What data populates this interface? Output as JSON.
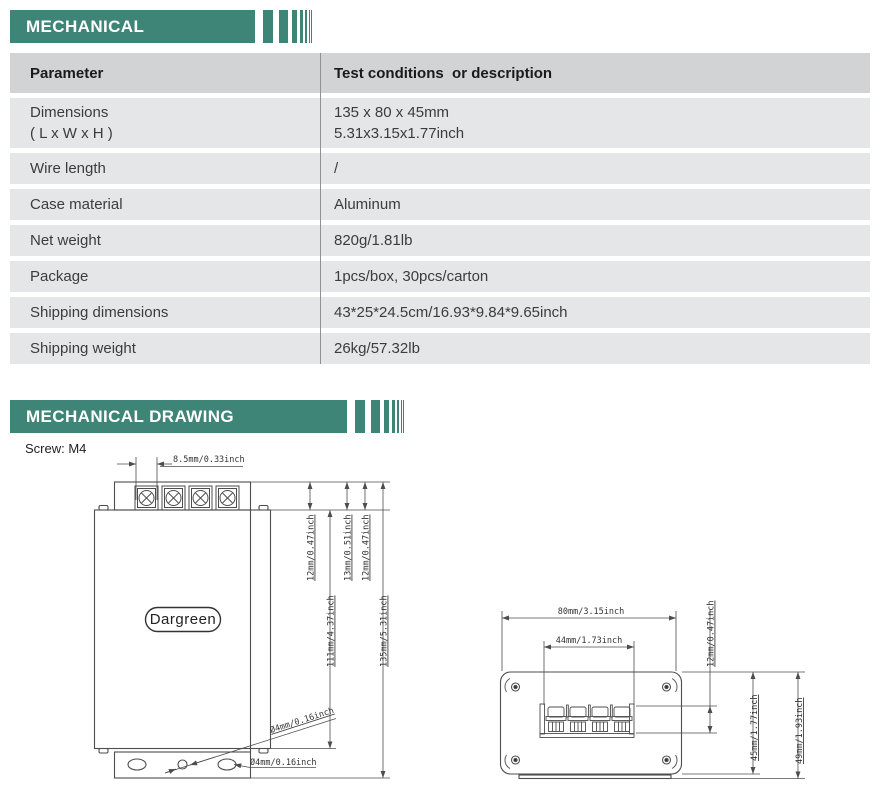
{
  "theme": {
    "accent_teal": "#3e8577",
    "table_header_bg": "#d1d3d4",
    "table_row_bg": "#e5e6e7"
  },
  "section_mechanical": {
    "title": "MECHANICAL"
  },
  "section_drawing": {
    "title": "MECHANICAL DRAWING",
    "screw_note": "Screw:  M4"
  },
  "table": {
    "header": {
      "col1": "Parameter",
      "col2": "Test conditions  or description"
    },
    "rows": [
      {
        "param": "Dimensions",
        "param2": "( L x W x H )",
        "value": "135 x 80 x 45mm",
        "value2": "5.31x3.15x1.77inch"
      },
      {
        "param": "Wire length",
        "param2": "",
        "value": "/",
        "value2": ""
      },
      {
        "param": "Case material",
        "param2": "",
        "value": "Aluminum",
        "value2": ""
      },
      {
        "param": "Net weight",
        "param2": "",
        "value": "820g/1.81lb",
        "value2": ""
      },
      {
        "param": "Package",
        "param2": "",
        "value": "1pcs/box, 30pcs/carton",
        "value2": ""
      },
      {
        "param": "Shipping dimensions",
        "param2": "",
        "value": "43*25*24.5cm/16.93*9.84*9.65inch",
        "value2": ""
      },
      {
        "param": "Shipping weight",
        "param2": "",
        "value": "26kg/57.32lb",
        "value2": ""
      }
    ]
  },
  "drawing_front": {
    "logo": "Dargreen",
    "dim_screw_pitch": "8.5mm/0.33inch",
    "dim_offset_1": "12mm/0.47inch",
    "dim_terminal_height": "13mm/0.51inch",
    "dim_offset_2": "12mm/0.47inch",
    "dim_body_height": "111mm/4.37inch",
    "dim_total_height": "135mm/5.31inch",
    "dim_hole_diagonal": "Ø4mm/0.16inch",
    "dim_hole_horizontal": "Ø4mm/0.16inch"
  },
  "drawing_side": {
    "dim_width": "80mm/3.15inch",
    "dim_terminal_width": "44mm/1.73inch",
    "dim_terminal_depth": "12mm/0.47inch",
    "dim_case_height": "45mm/1.77inch",
    "dim_total_height": "49mm/1.93inch"
  }
}
